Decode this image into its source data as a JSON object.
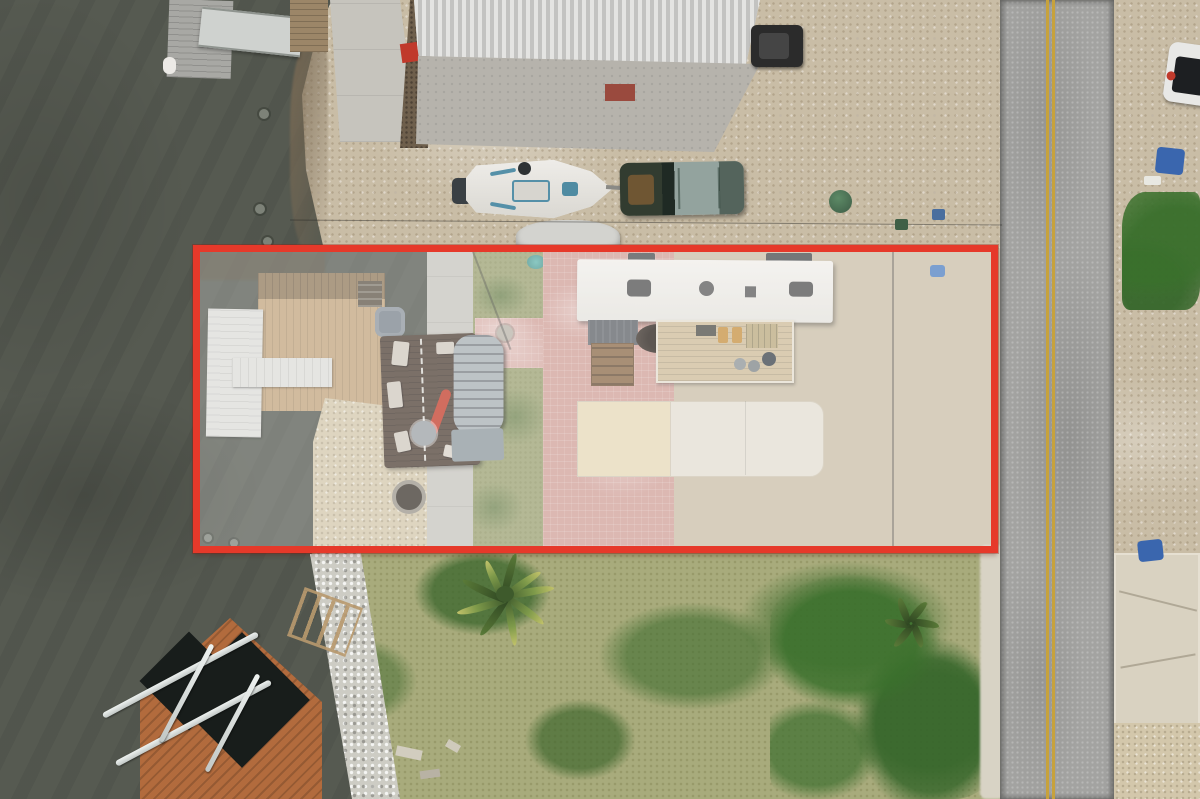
{
  "scene": {
    "type": "aerial-drone-photo",
    "description": "Top-down aerial photo of a waterfront residential lot outlined with a red property boundary; canal water on the left, paved road on the right, grassy lot below",
    "highlight": {
      "name": "property-boundary-outline",
      "color": "#e6392a",
      "interior_overlay": "rgba(255,255,255,0.26)"
    },
    "colors": {
      "water": "#565a51",
      "gravel": "#c9bda6",
      "road": "#a3a3a1",
      "road_centerline": "#c7a23c",
      "road_shoulder": "#d8d3c5",
      "grass_lot": "#a8ab7c",
      "grass_green_patch": "#4e7a3c",
      "lawn_strip": "#9aa071",
      "pink_paving": "#d0a098",
      "concrete_walk": "#c6c4bd",
      "concrete_apron": "#b6b3ac",
      "deck_wood": "#c2a47c",
      "deck_wood_dark": "#8f7859",
      "white_dock": "#dcdcd8",
      "orange_dock": "#b26b3d",
      "boat_slip_water": "#181d1b",
      "riprap_rocks": "#cdccc4",
      "shell_sand": "#d3c7ab",
      "metal_roof": "#dcdcda",
      "trailer_roof": "#eceae6",
      "pad_yellow": "#e6d8b6",
      "pad_white": "#e3ded2",
      "house_deck": "#4e3e34",
      "arched_roof": "#a7aeb2",
      "kayak": "#c23a28",
      "truck_body": "#38412f",
      "boat_hull": "#e9e9e6",
      "tarp": "#d3d3cf",
      "suv_white": "#e8e8e6",
      "bin_blue": "#3a66ae",
      "mulch": "#6e5f4c"
    },
    "objects": [
      {
        "name": "water-channel",
        "note": "dark canal water, left side"
      },
      {
        "name": "weathered-dock-top-left"
      },
      {
        "name": "aluminum-gangway"
      },
      {
        "name": "metal-roof-building"
      },
      {
        "name": "center-console-boat-on-trailer"
      },
      {
        "name": "pickup-truck"
      },
      {
        "name": "tarp-covered-boat"
      },
      {
        "name": "parked-dark-utility-vehicle"
      },
      {
        "name": "paved-road-double-yellow-line"
      },
      {
        "name": "white-suv-roadside"
      },
      {
        "name": "blue-trash-bins"
      },
      {
        "name": "red-property-outline"
      },
      {
        "name": "white-floating-dock"
      },
      {
        "name": "finger-pier"
      },
      {
        "name": "wooden-deck"
      },
      {
        "name": "deck-house-with-arched-metal-roof"
      },
      {
        "name": "red-kayak"
      },
      {
        "name": "manufactured-home-white-roof"
      },
      {
        "name": "patio-deck-with-furniture"
      },
      {
        "name": "hot-tub"
      },
      {
        "name": "concrete-parking-pad"
      },
      {
        "name": "pink-brick-patio"
      },
      {
        "name": "lawn-strip"
      },
      {
        "name": "gravel-yard"
      },
      {
        "name": "overhead-utility-lines"
      },
      {
        "name": "fire-pit"
      },
      {
        "name": "riprap-shoreline-rocks"
      },
      {
        "name": "orange-boat-lift-dock"
      },
      {
        "name": "aluminum-boat-lift-frame"
      },
      {
        "name": "grassy-vacant-lot"
      },
      {
        "name": "palm-tree"
      },
      {
        "name": "yucca-plant"
      },
      {
        "name": "cracked-concrete-driveway-slab"
      }
    ]
  }
}
